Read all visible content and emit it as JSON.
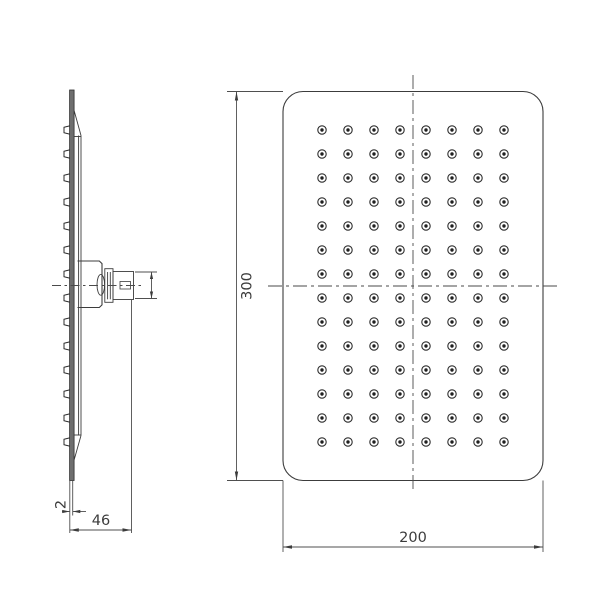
{
  "drawing": {
    "type": "technical-drawing-shower-head",
    "background": "#ffffff",
    "line_color": "#3c3c3c",
    "plate_fill": "#6e6e6e",
    "dimensions": {
      "front_height": "300",
      "front_width": "200",
      "side_depth": "46",
      "plate_thickness": "2"
    },
    "front_view": {
      "shape": "rounded-rectangle",
      "nozzle_grid": {
        "rows": 14,
        "columns": 8,
        "start_x": 322,
        "start_y": 130,
        "spacing_x": 26,
        "spacing_y": 24,
        "outer_radius": 4.2,
        "inner_radius": 1.7,
        "total_nozzles": 112
      }
    },
    "side_view": {
      "nozzle_count": 14,
      "nozzle_start_y": 130,
      "nozzle_spacing": 24
    }
  }
}
